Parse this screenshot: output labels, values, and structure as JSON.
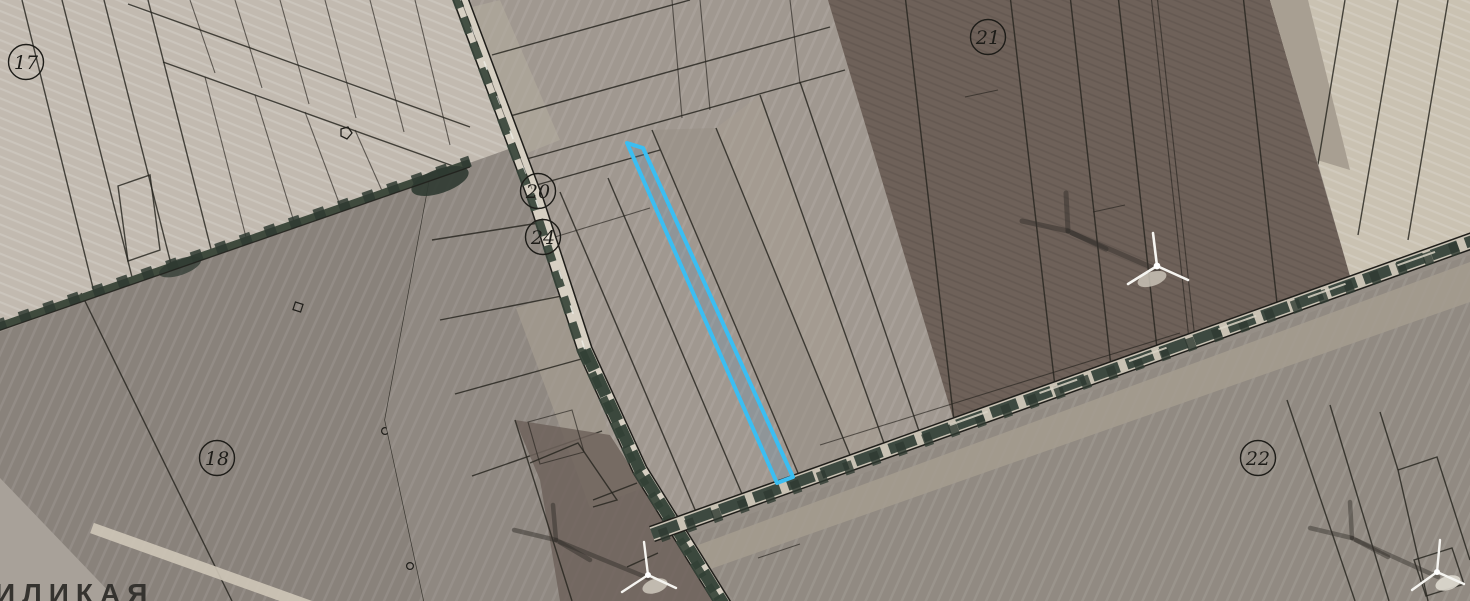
{
  "map": {
    "type": "cadastral-parcel-overlay-on-aerial-imagery",
    "highlight_color": "#3bbef2",
    "parcel_labels": [
      {
        "label": "17"
      },
      {
        "label": "18"
      },
      {
        "label": "20"
      },
      {
        "label": "24"
      },
      {
        "label": "21"
      },
      {
        "label": "22"
      }
    ],
    "place_name": "ИЛИКАЯ",
    "icons": [
      {
        "name": "wind-turbine-icon",
        "count": 3
      }
    ],
    "selected_parcel": {
      "shape": "narrow-strip",
      "outline_color": "#3bbef2"
    }
  }
}
